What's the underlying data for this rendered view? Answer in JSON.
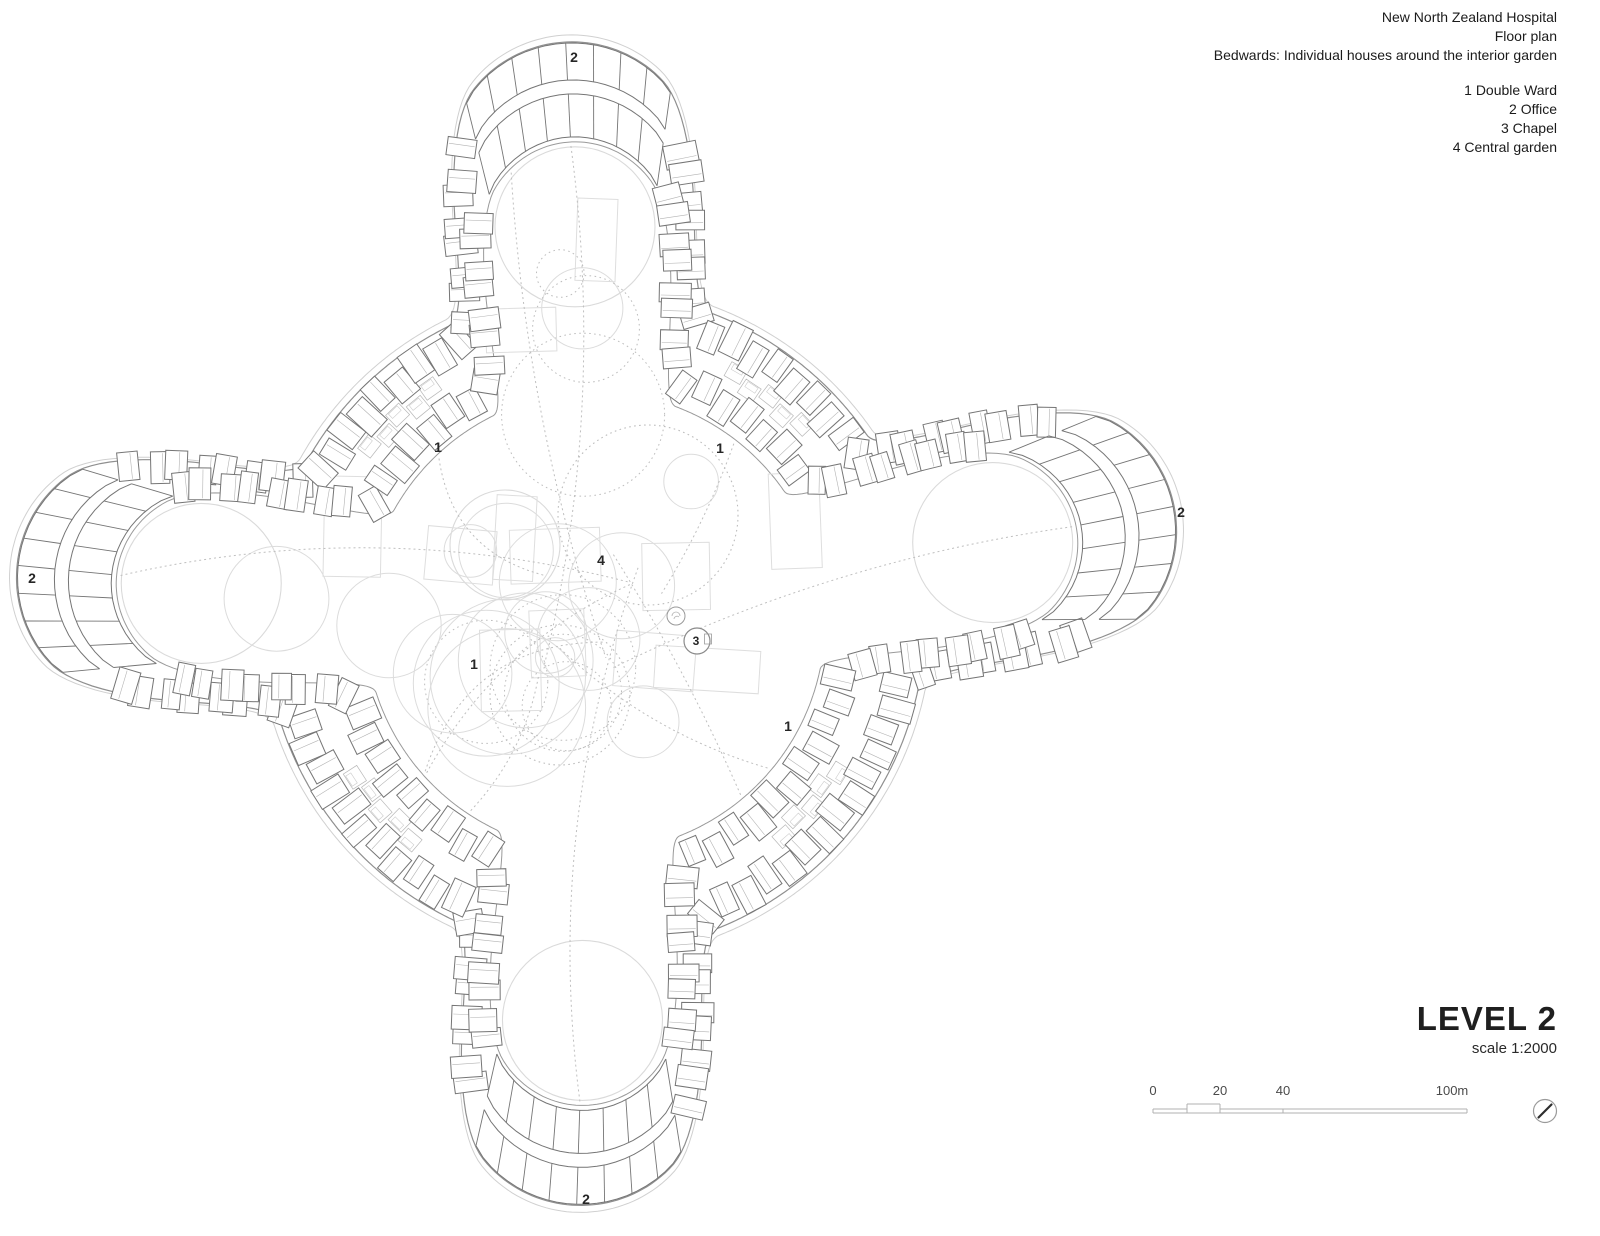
{
  "header": {
    "line1": "New North Zealand Hospital",
    "line2": "Floor plan",
    "line3": "Bedwards: Individual houses around the interior garden"
  },
  "legend": {
    "items": [
      {
        "num": "1",
        "label": "Double Ward"
      },
      {
        "num": "2",
        "label": "Office"
      },
      {
        "num": "3",
        "label": "Chapel"
      },
      {
        "num": "4",
        "label": "Central garden"
      }
    ]
  },
  "titleblock": {
    "level": "LEVEL 2",
    "scale": "scale 1:2000"
  },
  "scalebar": {
    "labels": [
      "0",
      "20",
      "40",
      "100m"
    ],
    "label_x": [
      1153,
      1220,
      1283,
      1452
    ],
    "label_y": 1095,
    "x0": 1153,
    "x10": 1187,
    "x20": 1220,
    "x40": 1283,
    "x100": 1467,
    "y_base": 1113,
    "y_low": 1109,
    "y_high": 1104,
    "color": "#b0b0b0",
    "text_color": "#4a4a4a"
  },
  "north_arrow": {
    "x": 1545,
    "y": 1111,
    "r": 11.5,
    "needle_color": "#2e2e2e",
    "ring_color": "#9a9a9a"
  },
  "plan": {
    "center": [
      595,
      622
    ],
    "base_radius": 330,
    "tip_radius": 131,
    "lobes": [
      {
        "angle_deg": -92.9,
        "dist": 452
      },
      {
        "angle_deg": -11.3,
        "dist": 462
      },
      {
        "angle_deg": 91.8,
        "dist": 455
      },
      {
        "angle_deg": 185.6,
        "dist": 452
      }
    ],
    "band": {
      "outer_row_depth": 20,
      "outer_room_w": 21,
      "outer_room_h": 31,
      "inner_row_depth": 76,
      "inner_room_w": 20,
      "inner_room_h": 29,
      "inner_edge_depth": 100,
      "room_spacing": 24,
      "faint_outer_offset": 7
    },
    "fan": {
      "half_angle_deg": 11,
      "outer_depths": [
        1,
        38
      ],
      "inner_depths": [
        52,
        95
      ],
      "radials": 9
    },
    "labels": [
      {
        "text": "2",
        "x": 574,
        "y": 57
      },
      {
        "text": "2",
        "x": 32,
        "y": 578
      },
      {
        "text": "2",
        "x": 1181,
        "y": 512
      },
      {
        "text": "2",
        "x": 586,
        "y": 1199
      },
      {
        "text": "1",
        "x": 438,
        "y": 447
      },
      {
        "text": "1",
        "x": 720,
        "y": 448
      },
      {
        "text": "1",
        "x": 474,
        "y": 664
      },
      {
        "text": "1",
        "x": 788,
        "y": 726
      },
      {
        "text": "4",
        "x": 601,
        "y": 560
      }
    ],
    "chapel": {
      "x": 697,
      "y": 641,
      "r": 13,
      "label": "3",
      "small_circle": {
        "x": 676,
        "y": 616,
        "r": 9
      }
    },
    "garden": {
      "seed": 11,
      "n_circles": 24,
      "n_rects": 12,
      "n_random_paths": 4,
      "featured_circles": [
        {
          "x": 648,
          "y": 515,
          "r": 90,
          "dotted": true
        },
        {
          "x": 560,
          "y": 695,
          "r": 70,
          "dotted": true
        },
        {
          "x": 505,
          "y": 545,
          "r": 55,
          "dotted": false
        }
      ],
      "lobe_circle": {
        "depth": 185,
        "r": 80
      }
    },
    "colors": {
      "room_stroke": "#757575",
      "boundary": "#8f8f8f",
      "inner_edge": "#9a9a9a",
      "faint_outer": "#d0d0d0",
      "garden_solid": "#dadada",
      "garden_dotted": "#bdbdbd",
      "path_dash": "#bfbfbf",
      "divider": "#b3b3b3",
      "wedge": "#b8b8b8",
      "label": "#262626"
    }
  }
}
